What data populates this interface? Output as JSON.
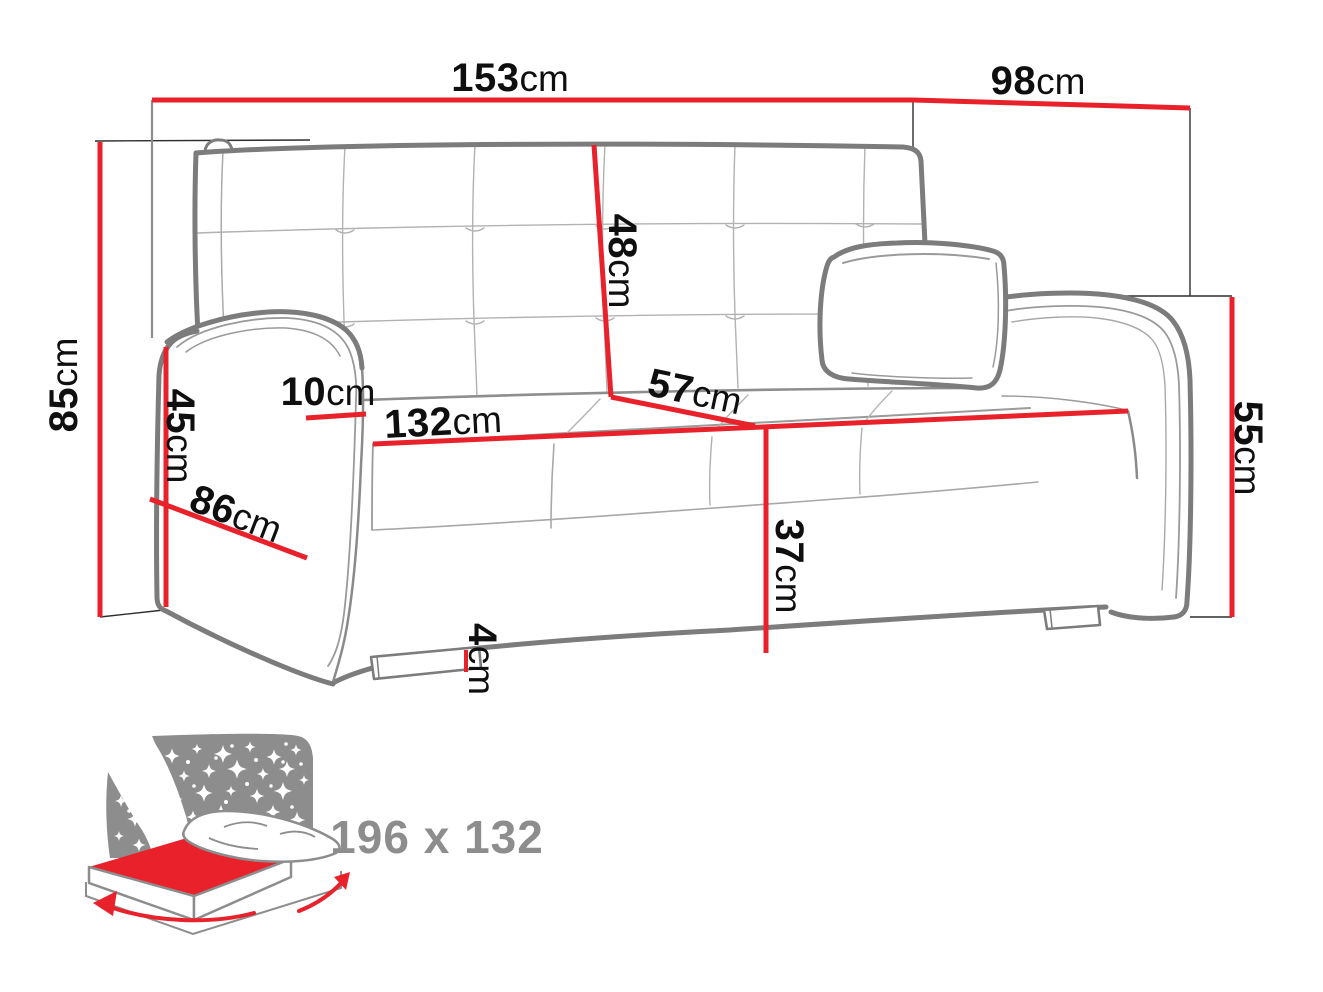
{
  "diagram": {
    "title": "sofa-bed-dimension-diagram",
    "unit": "cm",
    "labels": {
      "overall_width": {
        "value": "153",
        "unit": "cm"
      },
      "overall_depth": {
        "value": "98",
        "unit": "cm"
      },
      "overall_height": {
        "value": "85",
        "unit": "cm"
      },
      "armrest_front_height": {
        "value": "45",
        "unit": "cm"
      },
      "armrest_top_width": {
        "value": "10",
        "unit": "cm"
      },
      "armrest_depth": {
        "value": "86",
        "unit": "cm"
      },
      "seat_width": {
        "value": "132",
        "unit": "cm"
      },
      "seat_depth": {
        "value": "57",
        "unit": "cm"
      },
      "backrest_height": {
        "value": "48",
        "unit": "cm"
      },
      "seat_height": {
        "value": "37",
        "unit": "cm"
      },
      "leg_height": {
        "value": "4",
        "unit": "cm"
      },
      "arm_outer_height": {
        "value": "55",
        "unit": "cm"
      }
    },
    "sleeping_area": {
      "size_label": "196 x 132",
      "icon": "sleeping-area-night-bed-icon"
    },
    "icons": {
      "night_sky": "night-sky-stars-icon",
      "bed": "fold-out-bed-icon",
      "arrows": "dimension-arrows-icon"
    },
    "colors": {
      "dimension_red": "#e8212a",
      "outline_gray": "#7c7c7c",
      "icon_gray": "#8d8d8d",
      "label_black": "#0f0f0f"
    }
  }
}
